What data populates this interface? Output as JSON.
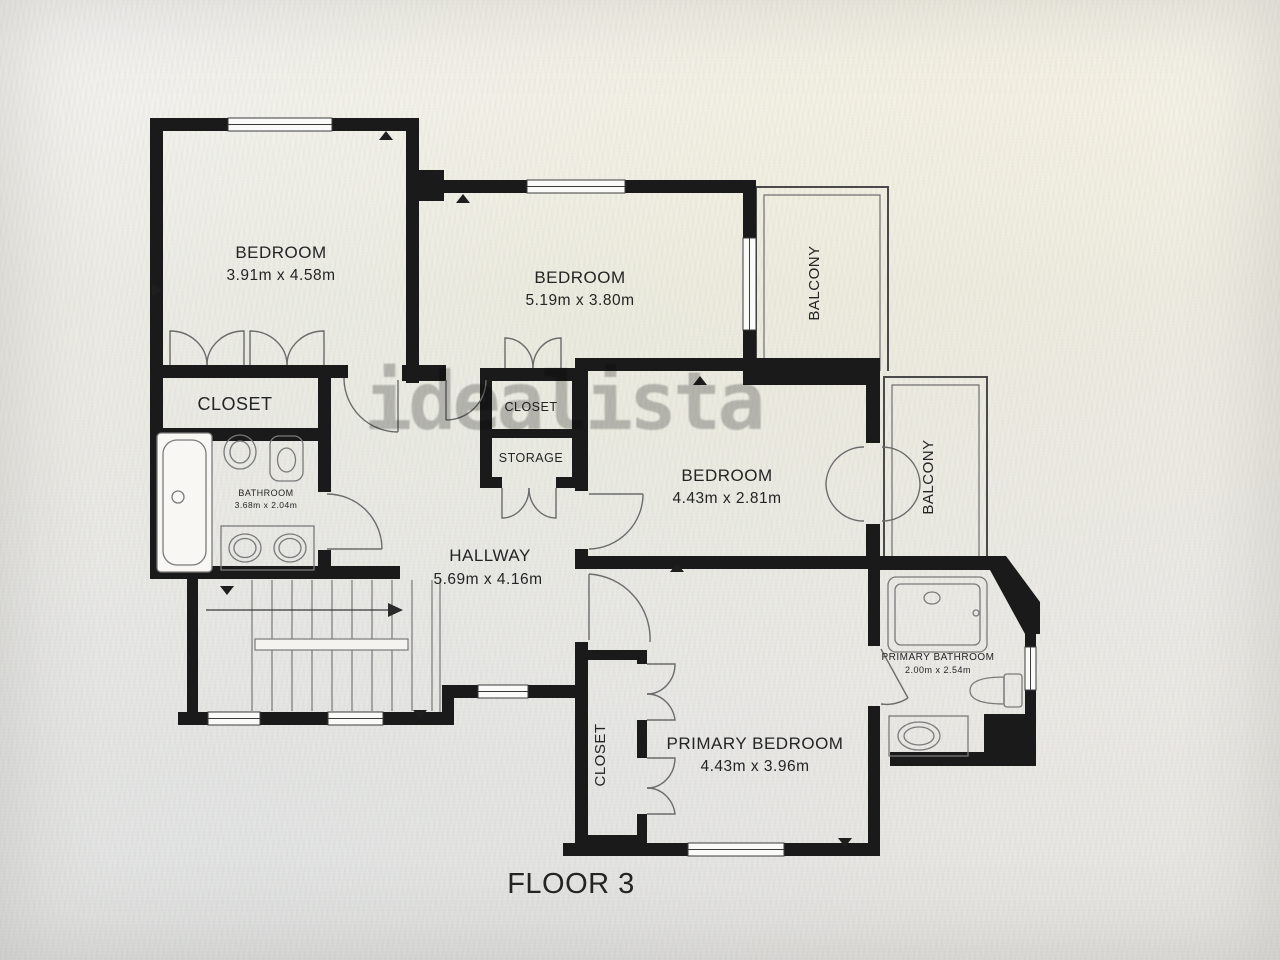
{
  "plan": {
    "floor_label": "FLOOR 3",
    "watermark": "idealista"
  },
  "colors": {
    "wall": "#1a1a1a",
    "text": "#242424",
    "watermark": "#8d8d8d",
    "background": "#e9e8e4"
  },
  "rooms": {
    "bedroom_1": {
      "label": "BEDROOM",
      "dims": "3.91m x 4.58m"
    },
    "bedroom_2": {
      "label": "BEDROOM",
      "dims": "5.19m x 3.80m"
    },
    "bedroom_3": {
      "label": "BEDROOM",
      "dims": "4.43m x 2.81m"
    },
    "primary_bedroom": {
      "label": "PRIMARY BEDROOM",
      "dims": "4.43m x 3.96m"
    },
    "hallway": {
      "label": "HALLWAY",
      "dims": "5.69m x 4.16m"
    },
    "bathroom": {
      "label": "BATHROOM",
      "dims": "3.68m x 2.04m"
    },
    "primary_bathroom": {
      "label": "PRIMARY BATHROOM",
      "dims": "2.00m x 2.54m"
    },
    "closet_bedroom_1": {
      "label": "CLOSET"
    },
    "closet_hall": {
      "label": "CLOSET"
    },
    "storage": {
      "label": "STORAGE"
    },
    "closet_primary": {
      "label": "CLOSET"
    },
    "balcony_top": {
      "label": "BALCONY"
    },
    "balcony_right": {
      "label": "BALCONY"
    }
  }
}
